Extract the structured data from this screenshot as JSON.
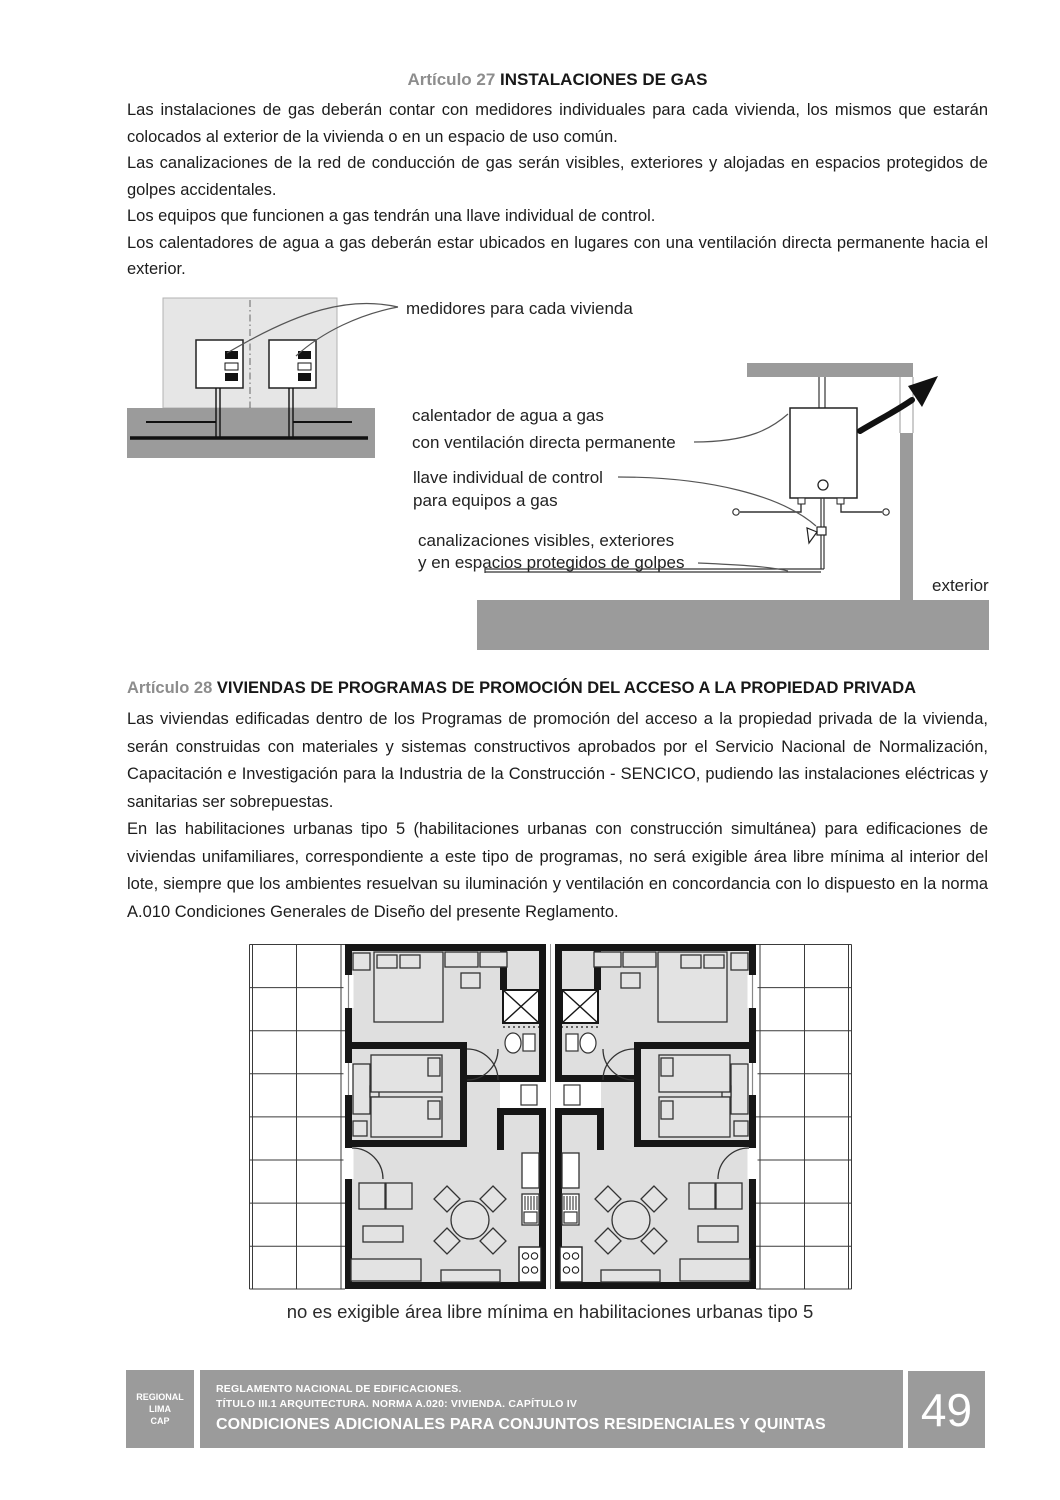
{
  "article27": {
    "label": "Artículo 27",
    "title": "INSTALACIONES DE GAS",
    "paragraphs": [
      "Las instalaciones de gas deberán contar con medidores individuales para cada vivienda, los mismos que estarán colocados al exterior de la vivienda o en un espacio de uso común.",
      "Las canalizaciones de la red de conducción de gas serán visibles, exteriores y alojadas en espacios protegidos de golpes accidentales.",
      "Los equipos que funcionen a gas tendrán una llave individual de control.",
      "Los calentadores de agua a gas deberán estar ubicados en lugares con una ventilación directa permanente hacia el exterior."
    ]
  },
  "gas_diagram": {
    "labels": {
      "medidores": "medidores para cada vivienda",
      "calentador_line1": "calentador de agua a gas",
      "calentador_line2": "con ventilación directa permanente",
      "llave_line1": "llave individual de control",
      "llave_line2": "para equipos a gas",
      "canalizaciones_line1": "canalizaciones visibles, exteriores",
      "canalizaciones_line2": "y en espacios protegidos de golpes",
      "exterior": "exterior"
    }
  },
  "article28": {
    "label": "Artículo 28",
    "title": "VIVIENDAS DE PROGRAMAS DE PROMOCIÓN DEL ACCESO A LA PROPIEDAD PRIVADA",
    "paragraphs": [
      "Las viviendas edificadas dentro de los Programas de promoción del acceso a la propiedad privada de la vivienda, serán construidas con materiales y sistemas constructivos aprobados por el Servicio Nacional de Normalización, Capacitación e Investigación para la Industria de la Construcción - SENCICO, pudiendo las instalaciones eléctricas y sanitarias ser sobrepuestas.",
      "En las habilitaciones urbanas tipo 5 (habilitaciones urbanas con construcción simultánea) para edificaciones de viviendas unifamiliares, correspondiente a este tipo de programas, no será exigible área libre mínima al interior del lote, siempre que los ambientes resuelvan su iluminación y ventilación en concordancia con lo dispuesto en la norma A.010 Condiciones Generales de Diseño del presente Reglamento."
    ]
  },
  "floor_plan": {
    "caption": "no es exigible área libre mínima en habilitaciones urbanas tipo 5"
  },
  "footer": {
    "org_lines": [
      "REGIONAL",
      "LIMA",
      "CAP"
    ],
    "doc_line1": "REGLAMENTO NACIONAL DE EDIFICACIONES.",
    "doc_line2": "TÍTULO III.1 ARQUITECTURA. NORMA A.020: VIVIENDA. CAPÍTULO IV",
    "doc_line3": "CONDICIONES ADICIONALES PARA CONJUNTOS RESIDENCIALES Y QUINTAS",
    "page_number": "49"
  },
  "colors": {
    "heading_gray": "#8d8d8d",
    "footer_gray": "#9b9b9b",
    "diagram_dark_gray": "#9b9b9b",
    "diagram_light_gray": "#e6e6e6",
    "plan_floor_gray": "#dfdfdf",
    "wall_black": "#161616"
  }
}
